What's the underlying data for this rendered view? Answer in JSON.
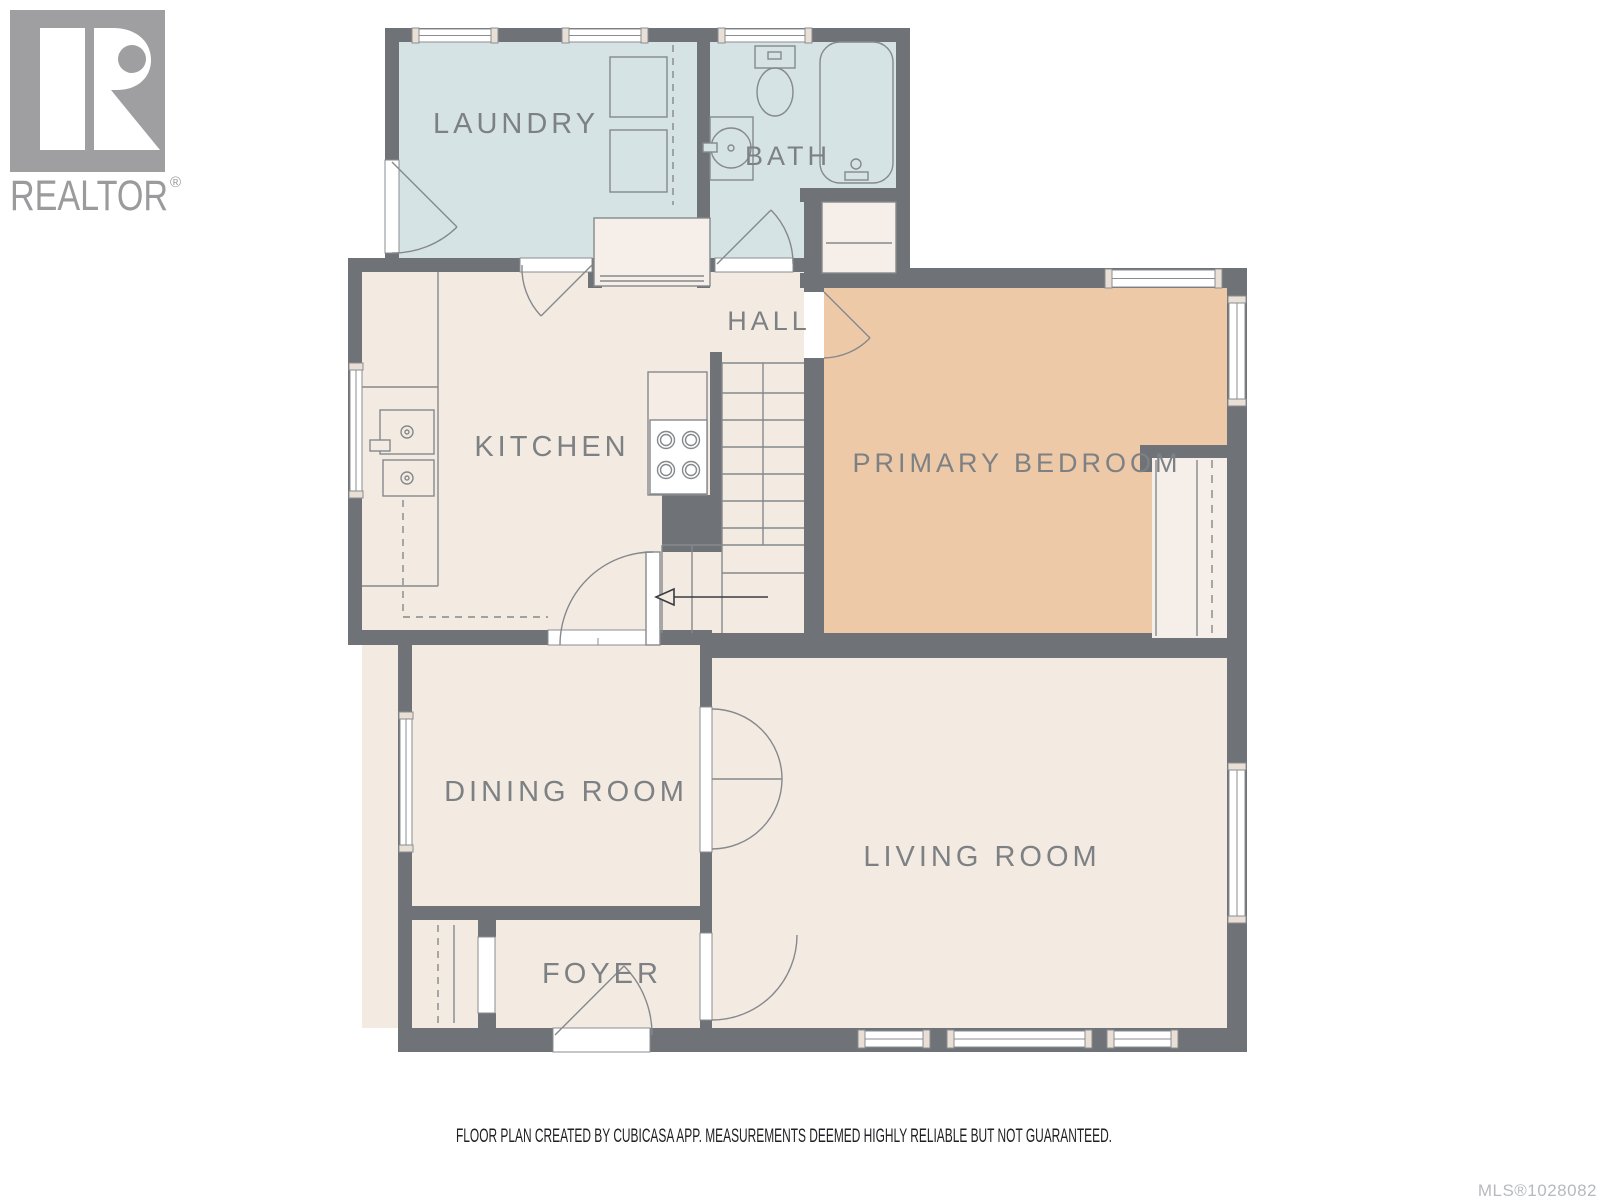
{
  "branding": {
    "logo_letter": "R",
    "logo_name": "REALTOR",
    "logo_reg": "®"
  },
  "rooms": {
    "laundry": {
      "label": "LAUNDRY"
    },
    "bath": {
      "label": "BATH"
    },
    "hall": {
      "label": "HALL"
    },
    "kitchen": {
      "label": "KITCHEN"
    },
    "primary_bedroom": {
      "label": "PRIMARY BEDROOM"
    },
    "dining": {
      "label": "DINING ROOM"
    },
    "living": {
      "label": "LIVING ROOM"
    },
    "foyer": {
      "label": "FOYER"
    }
  },
  "footer": {
    "disclaimer": "FLOOR PLAN CREATED BY CUBICASA APP. MEASUREMENTS DEEMED HIGHLY RELIABLE BUT NOT GUARANTEED.",
    "mls": "MLS®1028082"
  },
  "colors": {
    "wall": "#6f7276",
    "floor_cream": "#f3eae2",
    "floor_wet_blue": "#d5e3e5",
    "floor_bedroom_tan": "#edc9a7",
    "fixture_line": "#85898c",
    "label_text": "#7d8184",
    "logo_gray": "#9f9fa1",
    "window_cap": "#eadfd5",
    "disclaimer_text": "#202124",
    "mls_text": "#b7babd"
  }
}
